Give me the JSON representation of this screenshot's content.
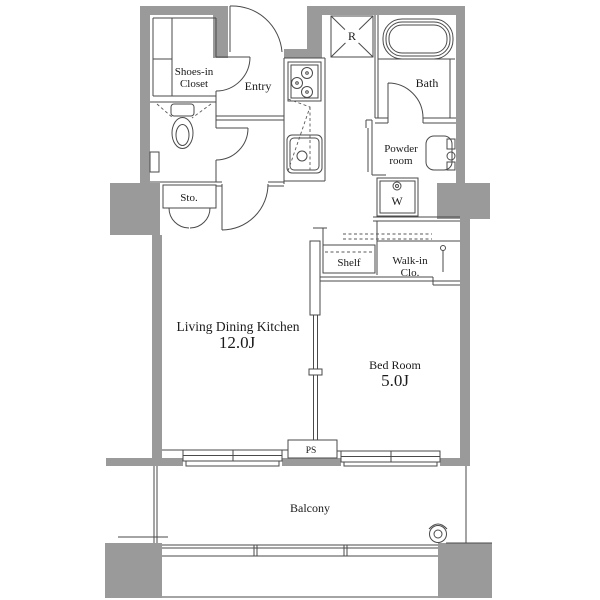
{
  "colors": {
    "wall_fill": "#9a9a9a",
    "line": "#4a4a4a",
    "text": "#1a1a1a",
    "background": "#ffffff"
  },
  "rooms": {
    "shoes_closet": {
      "line1": "Shoes-in",
      "line2": "Closet"
    },
    "entry": {
      "label": "Entry"
    },
    "refrigerator_space": {
      "label": "R"
    },
    "bath": {
      "label": "Bath"
    },
    "powder_room": {
      "line1": "Powder",
      "line2": "room"
    },
    "washer_space": {
      "label": "W"
    },
    "storage": {
      "label": "Sto."
    },
    "shelf": {
      "label": "Shelf"
    },
    "walk_in_closet": {
      "line1": "Walk-in",
      "line2": "Clo."
    },
    "ldk": {
      "label": "Living Dining Kitchen",
      "size": "12.0J"
    },
    "bedroom": {
      "label": "Bed Room",
      "size": "5.0J"
    },
    "pipe_space": {
      "label": "PS"
    },
    "balcony": {
      "label": "Balcony"
    }
  }
}
